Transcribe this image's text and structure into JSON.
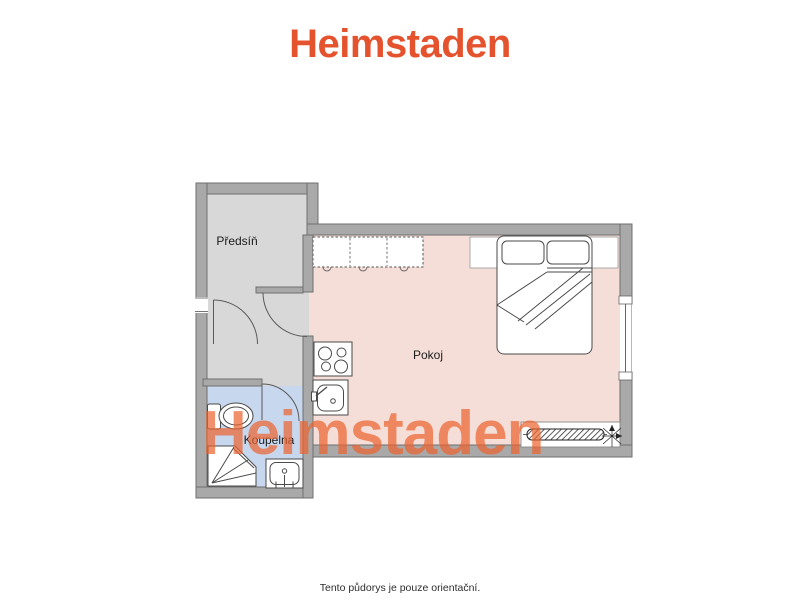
{
  "brand": {
    "logo_text": "Heimstaden",
    "logo_color": "#e5532e"
  },
  "watermark": {
    "text": "Heimstaden",
    "color": "#ec632d",
    "opacity": 0.7
  },
  "floorplan": {
    "wall_color": "#a9a9a9",
    "wall_outline_color": "#6f6f6f",
    "rooms": [
      {
        "label": "Předsíň",
        "fill": "#d8d8d8"
      },
      {
        "label": "Pokoj",
        "fill": "#f5ded8"
      },
      {
        "label": "Koupelna",
        "fill": "#c7d7ed"
      }
    ],
    "fixtures": [
      "kitchen-counter",
      "stove",
      "kitchen-sink",
      "bed",
      "pillows",
      "radiator",
      "window",
      "entry-door-opening",
      "interior-doors",
      "toilet",
      "shower",
      "washbasin",
      "compass-rose"
    ]
  },
  "footer": {
    "disclaimer": "Tento půdorys je pouze orientační."
  }
}
